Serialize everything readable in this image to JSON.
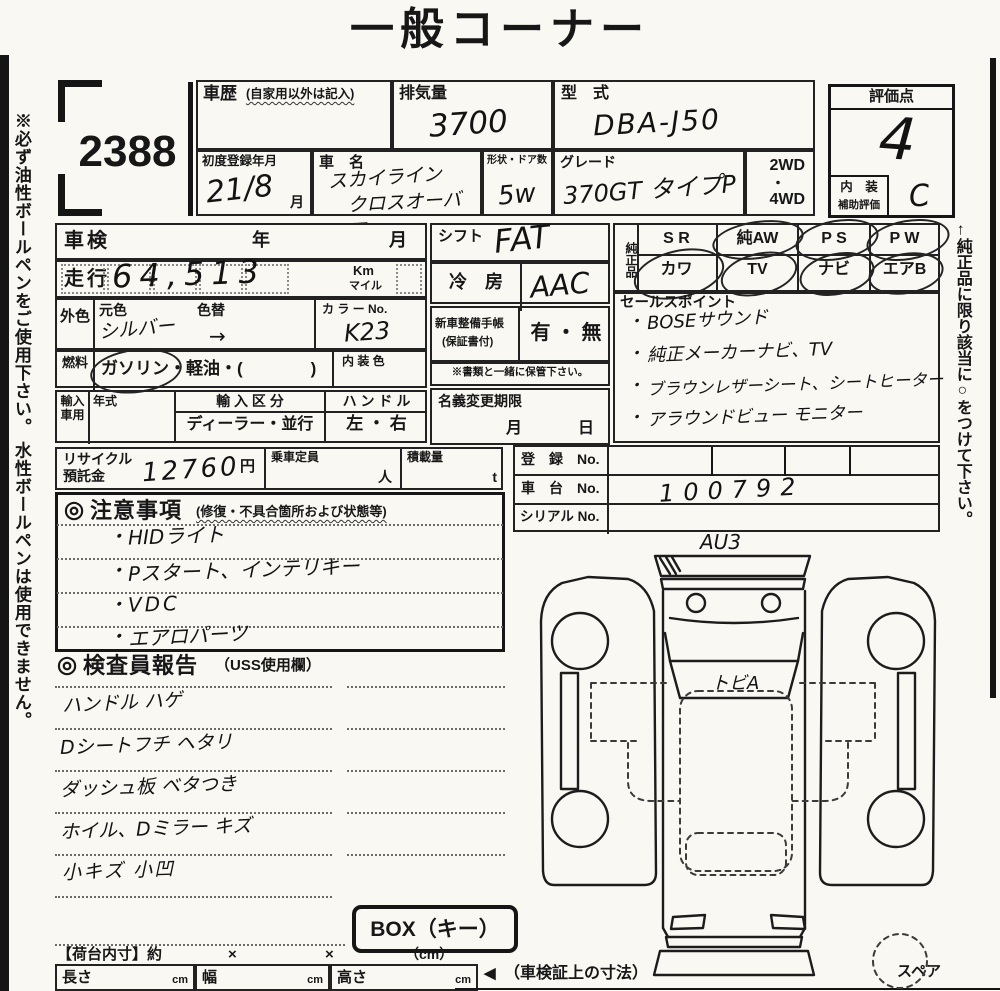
{
  "page": {
    "title": "一般コーナー",
    "lot": "2388",
    "left_note": "※必ず油性ボールペンをご使用下さい。 水性ボールペンは使用できません。",
    "right_note": "←純正品に限り該当に○をつけて下さい。"
  },
  "header": {
    "history": {
      "label": "車歴",
      "note": "(自家用以外は記入)"
    },
    "disp": {
      "label": "排気量",
      "value": "3700"
    },
    "model": {
      "label": "型　式",
      "value": "DBA-J50"
    },
    "firstreg": {
      "label": "初度登録年月",
      "value": "21/8",
      "unit": "月"
    },
    "name": {
      "label": "車　名",
      "line1": "スカイライン",
      "line2": "クロスオーバー"
    },
    "shape": {
      "label": "形状・ドア数",
      "value": "5w"
    },
    "grade": {
      "label": "グレード",
      "value": "370GT タイプP"
    },
    "drive": {
      "a": "2WD",
      "dot": "・",
      "b": "4WD"
    },
    "score": {
      "label": "評価点",
      "value": "4",
      "int1": "内　装",
      "int2": "補助評価",
      "int_value": "C"
    }
  },
  "lt": {
    "shaken": {
      "label": "車検",
      "y": "年",
      "m": "月"
    },
    "run": {
      "label": "走行",
      "value": "64,513",
      "km": "Km",
      "mile": "マイル"
    },
    "color": {
      "label": "外色",
      "moto": "元色",
      "kae": "色替",
      "value": "シルバー",
      "arrow": "→",
      "no_label": "カ ラ ー No.",
      "no": "K23"
    },
    "fuel": {
      "label": "燃料",
      "text": "ガソリン・軽油・(　　　　)",
      "interior": "内 装 色"
    },
    "imp": {
      "label": "輸入車用",
      "year": "年式",
      "kubun": "輸 入 区 分",
      "kubun_v": "ディーラー・並行",
      "handle": "ハ ン ド ル",
      "handle_v": "左 ・ 右"
    },
    "rec": {
      "l1": "リサイクル",
      "l2": "預託金",
      "value": "12760",
      "yen": "円",
      "teiin": "乗車定員",
      "nin": "人",
      "load": "積載量",
      "t": "t"
    }
  },
  "mid": {
    "shift": {
      "label": "シフト",
      "value": "FAT"
    },
    "ac": {
      "label": "冷　房",
      "value": "AAC"
    },
    "book": {
      "l1": "新車整備手帳",
      "l2": "(保証書付)",
      "value": "有 ・ 無"
    },
    "note": "※書類と一緒に保管下さい。",
    "transfer": {
      "label": "名義変更期限",
      "m": "月",
      "d": "日"
    }
  },
  "gp": {
    "label": "純正品",
    "cells": [
      {
        "top": "S R",
        "bottom": "カワ"
      },
      {
        "top": "純AW",
        "bottom": "TV"
      },
      {
        "top": "P S",
        "bottom": "ナビ"
      },
      {
        "top": "P W",
        "bottom": "エアB"
      }
    ]
  },
  "sp": {
    "label": "セールスポイント",
    "bullet": "・",
    "items": [
      "BOSEサウンド",
      "純正メーカーナビ、TV",
      "ブラウンレザーシート、シートヒーター",
      "アラウンドビュー モニター"
    ]
  },
  "reg": {
    "r1": "登　録　No.",
    "r2": "車　台　No.",
    "r2v": "100792",
    "r3": "シリアル No."
  },
  "ca": {
    "mark": "◎",
    "label": "注意事項",
    "sub": "(修復・不具合箇所および状態等)",
    "bullet": "・",
    "items": [
      "HIDライト",
      "Pスタート、インテリキー",
      "VDC",
      "エアロパーツ"
    ]
  },
  "ir": {
    "mark": "◎",
    "label": "検査員報告",
    "sub": "（USS使用欄）",
    "items": [
      "ハンドル ハゲ",
      "Dシートフチ ヘタリ",
      "ダッシュ板 ベタつき",
      "ホイル、Dミラー キズ",
      "小キズ 小凹"
    ]
  },
  "box": {
    "label": "BOX（キー）"
  },
  "cargo": {
    "label": "【荷台内寸】約",
    "times": "×",
    "unit": "（cm）",
    "len": "長さ",
    "wid": "幅",
    "hei": "高さ",
    "cm": "cm",
    "arrow": "◀",
    "note": "（車検証上の寸法）"
  },
  "diag": {
    "front": "AU3",
    "glass": "トビA",
    "spare": "スペア"
  }
}
